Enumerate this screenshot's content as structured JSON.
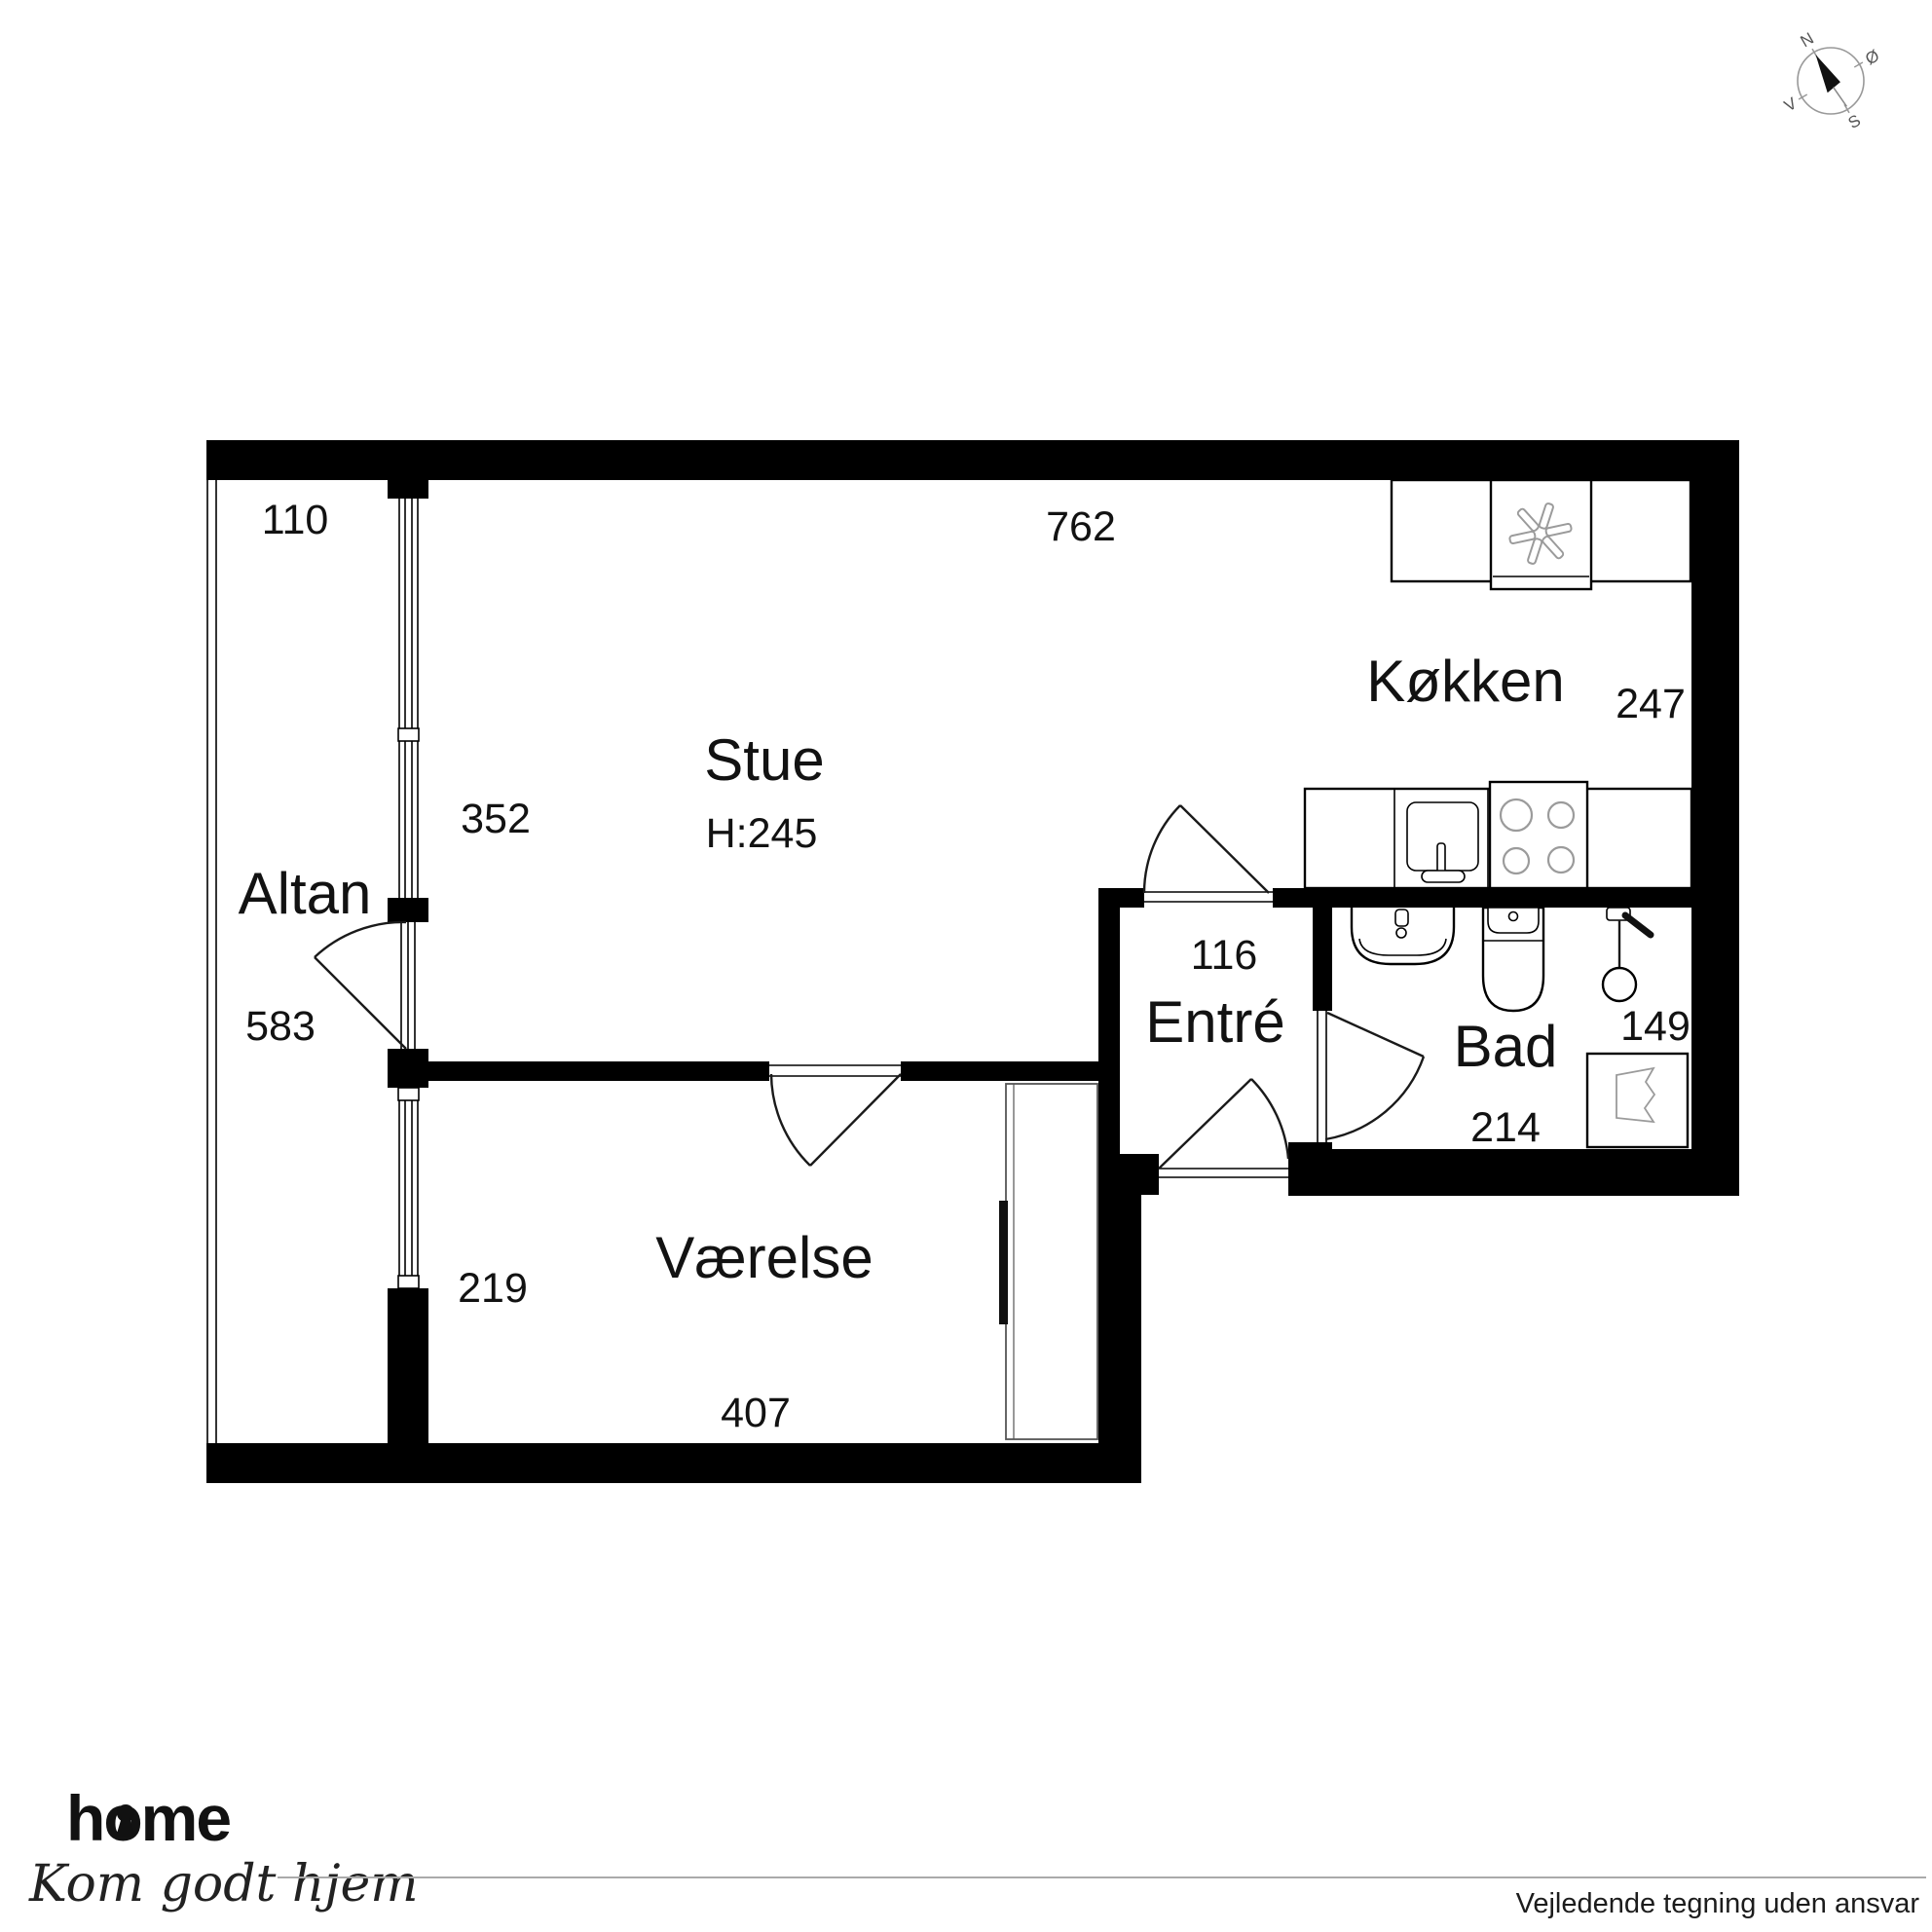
{
  "compass": {
    "north": "N",
    "east": "Ø",
    "south": "S",
    "west": "V"
  },
  "rooms": {
    "altan": {
      "label": "Altan",
      "width": "110",
      "length": "583"
    },
    "stue": {
      "label": "Stue",
      "ceiling_height": "H:245",
      "width": "762",
      "side": "352"
    },
    "koekken": {
      "label": "Køkken",
      "depth": "247"
    },
    "entre": {
      "label": "Entré",
      "width": "116"
    },
    "bad": {
      "label": "Bad",
      "width": "214",
      "depth": "149"
    },
    "vaerelse": {
      "label": "Værelse",
      "width": "407",
      "side": "219"
    }
  },
  "footer": {
    "brand": "home",
    "tagline": "Kom godt hjem",
    "disclaimer": "Vejledende tegning uden ansvar"
  },
  "colors": {
    "wall": "#000000",
    "brand_red": "#e41e26",
    "fixture_gray": "#9b9b9b"
  }
}
